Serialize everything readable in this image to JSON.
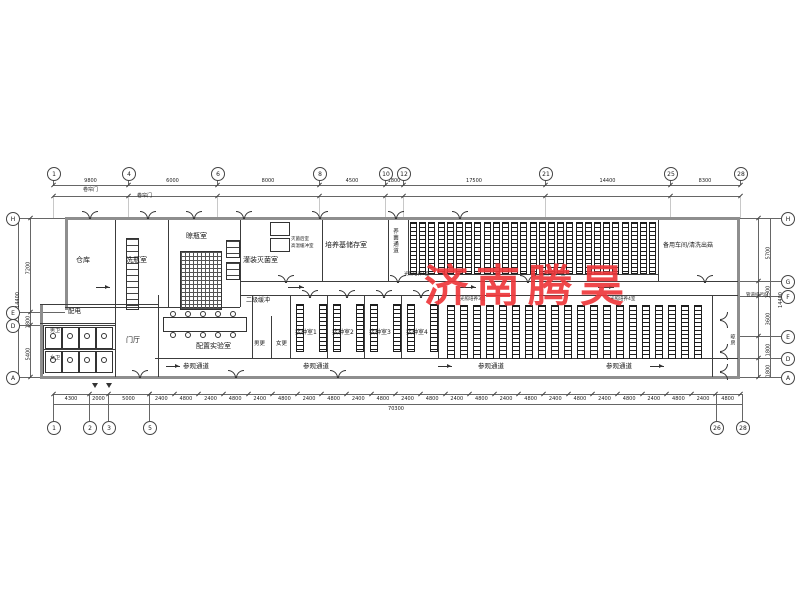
{
  "watermark": {
    "text": "济南腾昊",
    "color": "#ee383b"
  },
  "rooms": {
    "warehouse": "仓库",
    "bottle_washing": "洗瓶室",
    "bottle_drying": "晾瓶室",
    "filling_sterilizing": "灌装灭菌室",
    "sterilize_note_line1": "灭菌后室",
    "sterilize_note_line2": "高温缓冲室",
    "medium_storage": "培养基储存室",
    "fungus_corridor": "养菌通道",
    "spare_workshop": "备用车间/清洗出菇",
    "secondary_buffer": "二级缓冲",
    "power_distribution": "配电",
    "mens_toilet": "男卫",
    "womens_toilet": "女卫",
    "lobby": "门厅",
    "prep_lab": "配置实验室",
    "mens_changing": "男更",
    "womens_changing": "女更",
    "inoculation_1": "接种室1",
    "inoculation_2": "接种室2",
    "inoculation_3": "接种室3",
    "inoculation_4": "接种室4",
    "light_culture_1": "光照培养1室",
    "light_culture_2": "光照培养2室",
    "light_culture_3": "光照培养3室",
    "light_culture_4": "光照培养4室",
    "visiting_corridor": "参观通道",
    "drying_room": "晾房",
    "rollup_door": "卷帘门",
    "drain_outlet": "管道排污口"
  },
  "grid": {
    "top_bubbles": [
      "1",
      "4",
      "6",
      "8",
      "10",
      "12",
      "21",
      "25",
      "28"
    ],
    "bottom_bubbles": [
      "1",
      "2",
      "3",
      "5",
      "26",
      "28"
    ],
    "left_bubbles": [
      "H",
      "E",
      "D",
      "A"
    ],
    "right_bubbles": [
      "H",
      "G",
      "F",
      "E",
      "D",
      "A"
    ]
  },
  "dimensions": {
    "top": [
      "9800",
      "6000",
      "8000",
      "4500",
      "1800",
      "17500",
      "14400",
      "8300"
    ],
    "bottom_left": [
      "4300",
      "2000",
      "5000"
    ],
    "bottom_repeat": [
      "2400",
      "4800"
    ],
    "bottom_total": "70300",
    "left": [
      "7200",
      "1800",
      "5400"
    ],
    "left_total": "14400",
    "right": [
      "5700",
      "1500",
      "3600",
      "1800",
      "1800"
    ],
    "right_total": "14400"
  }
}
